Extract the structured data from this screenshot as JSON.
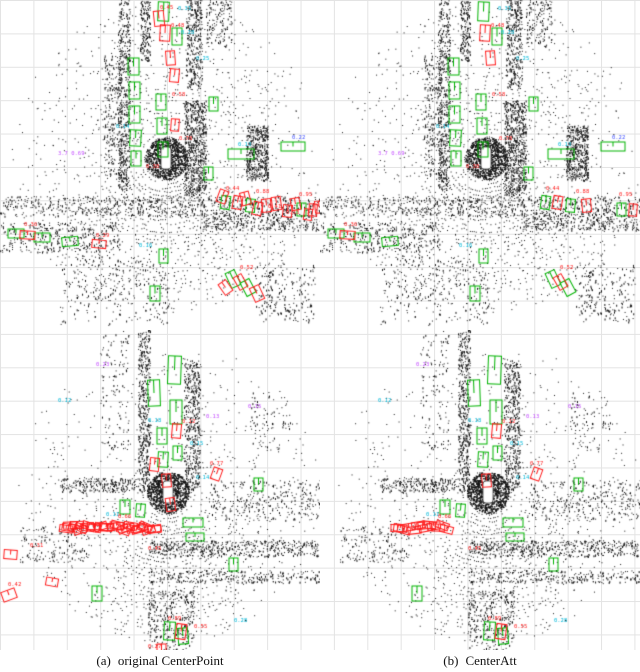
{
  "figure": {
    "captions": [
      {
        "label": "(a)",
        "text": "original CenterPoint"
      },
      {
        "label": "(b)",
        "text": "CenterAtt"
      }
    ]
  },
  "colors": {
    "green": "#00B300",
    "red": "#FF1A1A",
    "cyan": "#00B8D9",
    "magenta": "#C44DFF",
    "blue": "#4455FF",
    "point": "#161616",
    "grid": "#E3E3E3",
    "ego_fill": "#FFFFFF",
    "ego_stroke": "#444444"
  },
  "panels": [
    {
      "id": "0",
      "name": "original-centerpoint-scene-1",
      "scene": 0,
      "variant": "cp"
    },
    {
      "id": "1",
      "name": "centeratt-scene-1",
      "scene": 0,
      "variant": "ca"
    },
    {
      "id": "2",
      "name": "original-centerpoint-scene-2",
      "scene": 1,
      "variant": "cp"
    },
    {
      "id": "3",
      "name": "centeratt-scene-2",
      "scene": 1,
      "variant": "ca"
    }
  ],
  "scenes": [
    {
      "seed": 1007,
      "w": 320,
      "h": 330,
      "center": [
        166,
        158
      ],
      "rmax": 155,
      "sectors": [
        {
          "a0": 25,
          "a1": 155,
          "f": 1.0
        },
        {
          "a0": 155,
          "a1": 205,
          "f": 0.35
        },
        {
          "a0": 205,
          "a1": 335,
          "f": 0.5
        },
        {
          "a0": 335,
          "a1": 385,
          "f": 0.3
        }
      ],
      "clutter": [
        {
          "x": 118,
          "y": 0,
          "w": 12,
          "h": 190,
          "n": 500
        },
        {
          "x": 186,
          "y": 0,
          "w": 16,
          "h": 90,
          "n": 350
        },
        {
          "x": 184,
          "y": 100,
          "w": 22,
          "h": 95,
          "n": 700
        },
        {
          "x": 246,
          "y": 125,
          "w": 22,
          "h": 55,
          "n": 500
        },
        {
          "x": 0,
          "y": 196,
          "w": 320,
          "h": 20,
          "n": 700
        },
        {
          "x": 200,
          "y": 216,
          "w": 120,
          "h": 14,
          "n": 260
        },
        {
          "x": 0,
          "y": 222,
          "w": 120,
          "h": 30,
          "n": 320
        },
        {
          "x": 206,
          "y": 0,
          "w": 26,
          "h": 46,
          "n": 140
        },
        {
          "x": 140,
          "y": 0,
          "w": 10,
          "h": 60,
          "n": 180
        },
        {
          "x": 60,
          "y": 255,
          "w": 110,
          "h": 70,
          "n": 260
        },
        {
          "x": 255,
          "y": 262,
          "w": 60,
          "h": 60,
          "n": 220
        },
        {
          "x": 104,
          "y": 55,
          "w": 18,
          "h": 120,
          "n": 260
        }
      ],
      "green": [
        [
          128,
          58,
          11,
          17,
          0
        ],
        [
          129,
          82,
          11,
          17,
          0
        ],
        [
          129,
          106,
          11,
          17,
          0
        ],
        [
          130,
          130,
          11,
          16,
          3
        ],
        [
          131,
          151,
          10,
          15,
          0
        ],
        [
          158,
          2,
          11,
          19,
          2
        ],
        [
          172,
          28,
          10,
          17,
          0
        ],
        [
          156,
          94,
          10,
          16,
          0
        ],
        [
          157,
          118,
          10,
          16,
          0
        ],
        [
          158,
          142,
          10,
          15,
          0
        ],
        [
          209,
          97,
          9,
          14,
          0
        ],
        [
          228,
          149,
          26,
          10,
          0
        ],
        [
          281,
          142,
          24,
          9,
          0
        ],
        [
          221,
          196,
          9,
          13,
          8
        ],
        [
          246,
          199,
          9,
          13,
          5
        ],
        [
          297,
          203,
          9,
          13,
          0
        ],
        [
          8,
          229,
          16,
          9,
          0
        ],
        [
          34,
          233,
          16,
          9,
          0
        ],
        [
          62,
          237,
          16,
          9,
          -5
        ],
        [
          228,
          271,
          10,
          16,
          -25
        ],
        [
          243,
          280,
          10,
          15,
          -28
        ],
        [
          159,
          249,
          9,
          14,
          0
        ],
        [
          150,
          286,
          10,
          15,
          0
        ],
        [
          204,
          167,
          9,
          13,
          0
        ]
      ],
      "red": [
        [
          160,
          25,
          10,
          16,
          3
        ],
        [
          166,
          51,
          9,
          14,
          -4
        ],
        [
          233,
          196,
          9,
          13,
          10
        ],
        [
          262,
          199,
          9,
          13,
          -6
        ],
        [
          309,
          204,
          8,
          12,
          4
        ],
        [
          236,
          275,
          9,
          14,
          -30
        ],
        [
          20,
          231,
          15,
          8,
          3
        ]
      ],
      "red_cp": [
        [
          154,
          11,
          10,
          15,
          -6
        ],
        [
          170,
          69,
          9,
          13,
          5
        ],
        [
          218,
          190,
          9,
          13,
          20
        ],
        [
          241,
          192,
          9,
          13,
          -15
        ],
        [
          253,
          202,
          9,
          13,
          12
        ],
        [
          272,
          197,
          9,
          13,
          -8
        ],
        [
          283,
          205,
          9,
          12,
          6
        ],
        [
          291,
          198,
          9,
          12,
          -10
        ],
        [
          304,
          209,
          8,
          11,
          8
        ],
        [
          315,
          201,
          8,
          12,
          -5
        ],
        [
          252,
          286,
          10,
          15,
          -25
        ],
        [
          221,
          281,
          9,
          13,
          -35
        ],
        [
          92,
          240,
          14,
          8,
          5
        ],
        [
          171,
          119,
          8,
          12,
          4
        ]
      ],
      "labels": [
        {
          "t": "0.31",
          "c": "c",
          "x": 178,
          "y": 10
        },
        {
          "t": "0.28",
          "c": "c",
          "x": 181,
          "y": 34
        },
        {
          "t": "0.25",
          "c": "c",
          "x": 196,
          "y": 60
        },
        {
          "t": "0.14",
          "c": "c",
          "x": 116,
          "y": 128
        },
        {
          "t": "0.16",
          "c": "c",
          "x": 139,
          "y": 247
        },
        {
          "t": "0.13",
          "c": "c",
          "x": 238,
          "y": 146
        },
        {
          "t": "0.22",
          "c": "b",
          "x": 292,
          "y": 139
        },
        {
          "t": "3.7 0.69",
          "c": "m",
          "x": 58,
          "y": 155
        },
        {
          "t": "0.48",
          "c": "r",
          "x": 171,
          "y": 27
        },
        {
          "t": "0.58",
          "c": "r",
          "x": 172,
          "y": 96
        },
        {
          "t": "0.78",
          "c": "r",
          "x": 179,
          "y": 140
        },
        {
          "t": "0.38",
          "c": "r",
          "x": 146,
          "y": 168
        },
        {
          "t": "0.44",
          "c": "r",
          "x": 226,
          "y": 190
        },
        {
          "t": "0.88",
          "c": "r",
          "x": 256,
          "y": 193
        },
        {
          "t": "0.52",
          "c": "r",
          "x": 240,
          "y": 269
        },
        {
          "t": "0.36",
          "c": "r",
          "x": 24,
          "y": 226
        },
        {
          "t": "0.95",
          "c": "r",
          "x": 299,
          "y": 196
        }
      ],
      "labels_cp": [
        {
          "t": "0.45",
          "c": "r",
          "x": 160,
          "y": 9
        },
        {
          "t": "0.41",
          "c": "r",
          "x": 268,
          "y": 208
        },
        {
          "t": "0.33",
          "c": "r",
          "x": 286,
          "y": 214
        },
        {
          "t": "0.29",
          "c": "r",
          "x": 96,
          "y": 237
        }
      ]
    },
    {
      "seed": 2013,
      "w": 320,
      "h": 320,
      "center": [
        168,
        162
      ],
      "rmax": 150,
      "sectors": [
        {
          "a0": 55,
          "a1": 125,
          "f": 1.0
        },
        {
          "a0": 125,
          "a1": 180,
          "f": 0.45
        },
        {
          "a0": 0,
          "a1": 55,
          "f": 0.45
        },
        {
          "a0": 180,
          "a1": 360,
          "f": 0.28
        }
      ],
      "clutter": [
        {
          "x": 138,
          "y": 0,
          "w": 12,
          "h": 150,
          "n": 420
        },
        {
          "x": 184,
          "y": 30,
          "w": 16,
          "h": 130,
          "n": 480
        },
        {
          "x": 60,
          "y": 148,
          "w": 100,
          "h": 14,
          "n": 300
        },
        {
          "x": 148,
          "y": 210,
          "w": 170,
          "h": 16,
          "n": 450
        },
        {
          "x": 150,
          "y": 240,
          "w": 170,
          "h": 12,
          "n": 260
        },
        {
          "x": 148,
          "y": 260,
          "w": 46,
          "h": 60,
          "n": 300
        },
        {
          "x": 210,
          "y": 150,
          "w": 110,
          "h": 40,
          "n": 280
        },
        {
          "x": 20,
          "y": 196,
          "w": 70,
          "h": 36,
          "n": 160
        },
        {
          "x": 100,
          "y": 0,
          "w": 30,
          "h": 120,
          "n": 120
        },
        {
          "x": 250,
          "y": 60,
          "w": 40,
          "h": 60,
          "n": 80
        }
      ],
      "green": [
        [
          168,
          26,
          13,
          28,
          2
        ],
        [
          148,
          50,
          12,
          26,
          -2
        ],
        [
          170,
          70,
          12,
          24,
          0
        ],
        [
          157,
          98,
          10,
          16,
          0
        ],
        [
          158,
          122,
          10,
          15,
          3
        ],
        [
          173,
          116,
          9,
          14,
          0
        ],
        [
          183,
          188,
          20,
          9,
          0
        ],
        [
          186,
          203,
          18,
          8,
          0
        ],
        [
          254,
          148,
          9,
          13,
          0
        ],
        [
          164,
          292,
          11,
          18,
          3
        ],
        [
          178,
          298,
          10,
          16,
          -5
        ],
        [
          120,
          170,
          10,
          14,
          0
        ],
        [
          136,
          174,
          9,
          13,
          4
        ],
        [
          92,
          256,
          10,
          15,
          0
        ],
        [
          229,
          228,
          9,
          13,
          0
        ]
      ],
      "red": [
        [
          172,
          94,
          9,
          14,
          5
        ],
        [
          162,
          144,
          9,
          13,
          -4
        ],
        [
          176,
          294,
          10,
          15,
          8
        ],
        [
          212,
          138,
          9,
          12,
          20
        ]
      ],
      "red_cp": [
        [
          150,
          128,
          9,
          13,
          6
        ],
        [
          166,
          168,
          9,
          13,
          -8
        ],
        [
          4,
          220,
          13,
          9,
          4
        ],
        [
          2,
          260,
          14,
          10,
          -20
        ],
        [
          46,
          248,
          12,
          8,
          10
        ],
        [
          157,
          314,
          9,
          12,
          0
        ]
      ],
      "streak": {
        "y": 194,
        "h": 7,
        "cp": {
          "x0": 58,
          "x1": 150,
          "n": 30
        },
        "ca": {
          "x0": 70,
          "x1": 122,
          "n": 13
        }
      },
      "labels": [
        {
          "t": "0.15",
          "c": "c",
          "x": 190,
          "y": 115
        },
        {
          "t": "0.18",
          "c": "c",
          "x": 148,
          "y": 92
        },
        {
          "t": "0.14",
          "c": "c",
          "x": 196,
          "y": 149
        },
        {
          "t": "0.11",
          "c": "c",
          "x": 106,
          "y": 186
        },
        {
          "t": "0.28",
          "c": "c",
          "x": 234,
          "y": 292
        },
        {
          "t": "0.12",
          "c": "c",
          "x": 58,
          "y": 72
        },
        {
          "t": "0.13",
          "c": "m",
          "x": 206,
          "y": 88
        },
        {
          "t": "0.15",
          "c": "m",
          "x": 248,
          "y": 78
        },
        {
          "t": "0.23",
          "c": "m",
          "x": 96,
          "y": 36
        },
        {
          "t": "0.12",
          "c": "r",
          "x": 182,
          "y": 93
        },
        {
          "t": "0.77",
          "c": "r",
          "x": 210,
          "y": 135
        },
        {
          "t": "0.45",
          "c": "r",
          "x": 148,
          "y": 220
        },
        {
          "t": "0.89",
          "c": "r",
          "x": 168,
          "y": 290
        },
        {
          "t": "0.55",
          "c": "r",
          "x": 194,
          "y": 298
        },
        {
          "t": "0.66",
          "c": "r",
          "x": 118,
          "y": 188
        }
      ],
      "labels_cp": [
        {
          "t": "0.31",
          "c": "r",
          "x": 30,
          "y": 217
        },
        {
          "t": "0.42",
          "c": "r",
          "x": 8,
          "y": 256
        },
        {
          "t": "0.27",
          "c": "r",
          "x": 148,
          "y": 318
        }
      ]
    }
  ]
}
